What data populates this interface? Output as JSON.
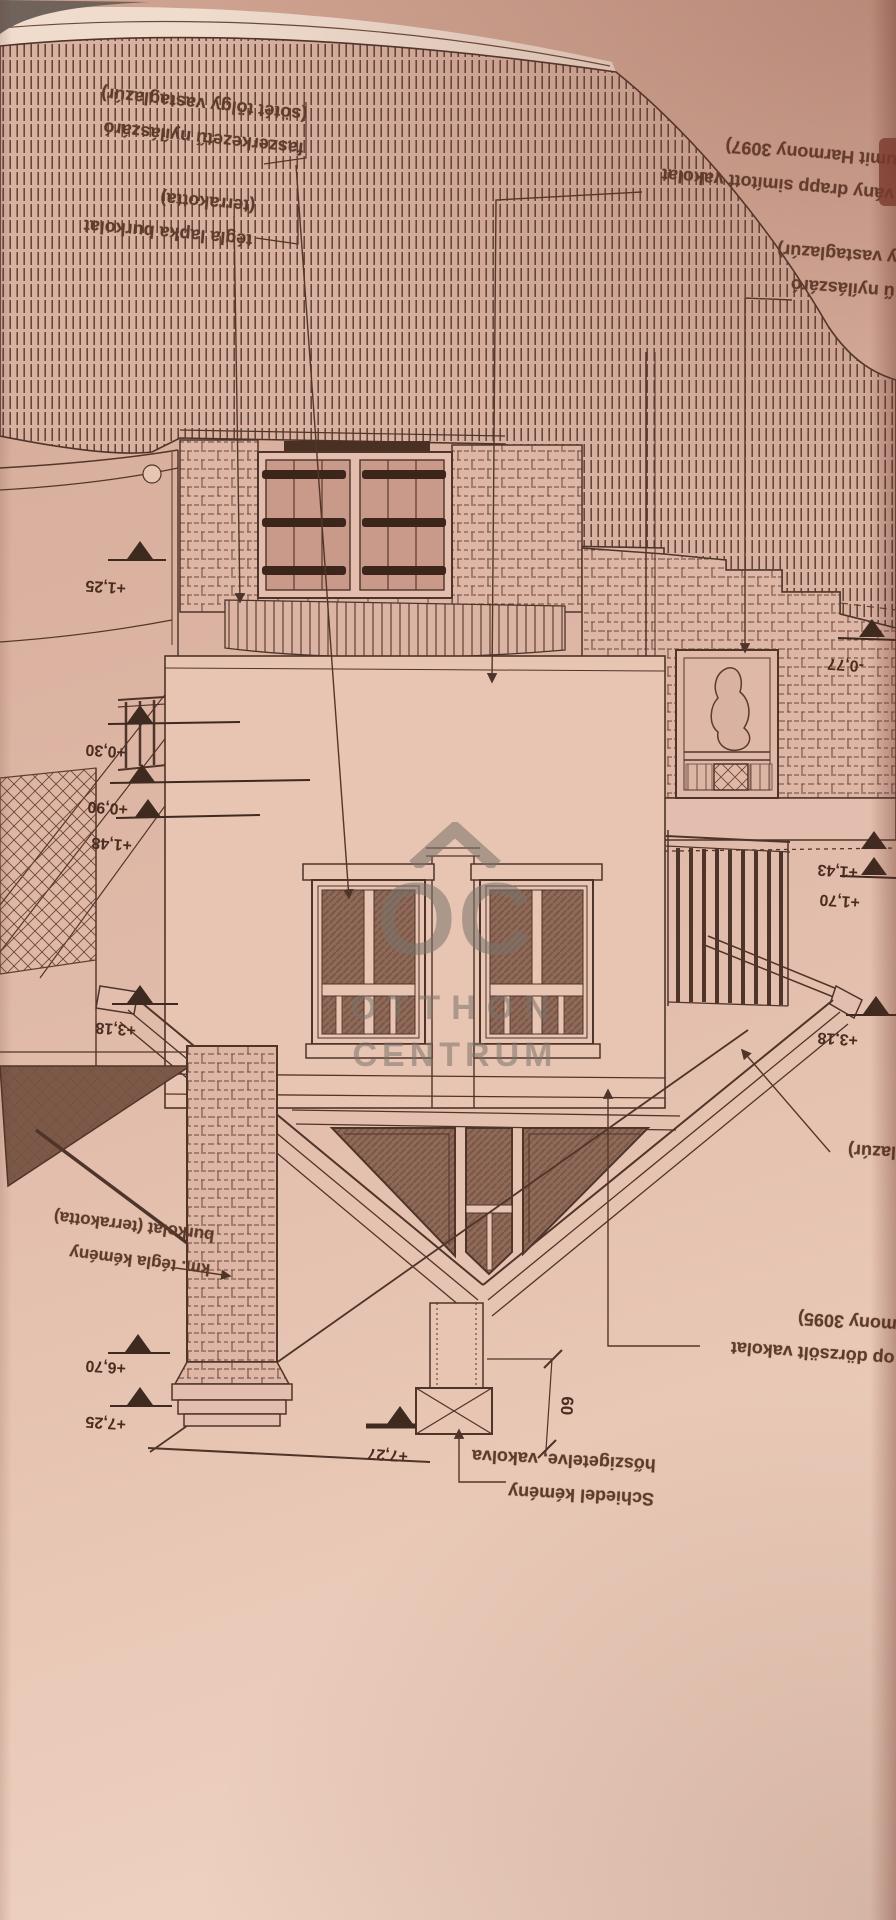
{
  "watermark": {
    "logo": "OC",
    "line1": "OTTHON",
    "line2": "CENTRUM"
  },
  "labels": {
    "timber_window": {
      "line1": "faszerkezetű nyílászáró",
      "line2": "(sötét tölgy vastaglazúr)"
    },
    "brick_tile": {
      "line1": "tégla lapka burkolat",
      "line2": "(terrakotta)"
    },
    "smooth_plaster": {
      "line1": "vány drapp simított vakolat",
      "line2": "umit Harmony 3097)"
    },
    "right_window": {
      "line1": "ű nyílászáró",
      "line2": "y vastaglazúr)"
    },
    "glaze_partial": {
      "line1": "lazúr)"
    },
    "rubbed_plaster": {
      "line1": "op dörzsölt vakolat",
      "line2": "mony 3095)"
    },
    "chimney_cladding": {
      "line1": "km. tégla kémény",
      "line2": "burkolat (terrakotta)"
    },
    "schiedel": {
      "line1": "Schiedel kémény",
      "line2": "hőszigetelve, vakolva"
    }
  },
  "markers": {
    "m1_25": "+1,25",
    "m0_30": "+0,30",
    "m0_90": "+0,90",
    "m1_48": "+1,48",
    "m0_77": "-0,77",
    "m1_43": "+1,43",
    "m1_70": "+1,70",
    "m3_18_left": "+3,18",
    "m3_18_right": "+3,18",
    "m6_70": "+6,70",
    "m7_25": "+7,25",
    "m7_27": "+7,27"
  },
  "dimensions": {
    "chimney_offset": "60"
  },
  "colors": {
    "paper": "#e3bdad",
    "ink": "#53362a",
    "dark": "#3f2a20",
    "watermark": "#7a726b"
  }
}
